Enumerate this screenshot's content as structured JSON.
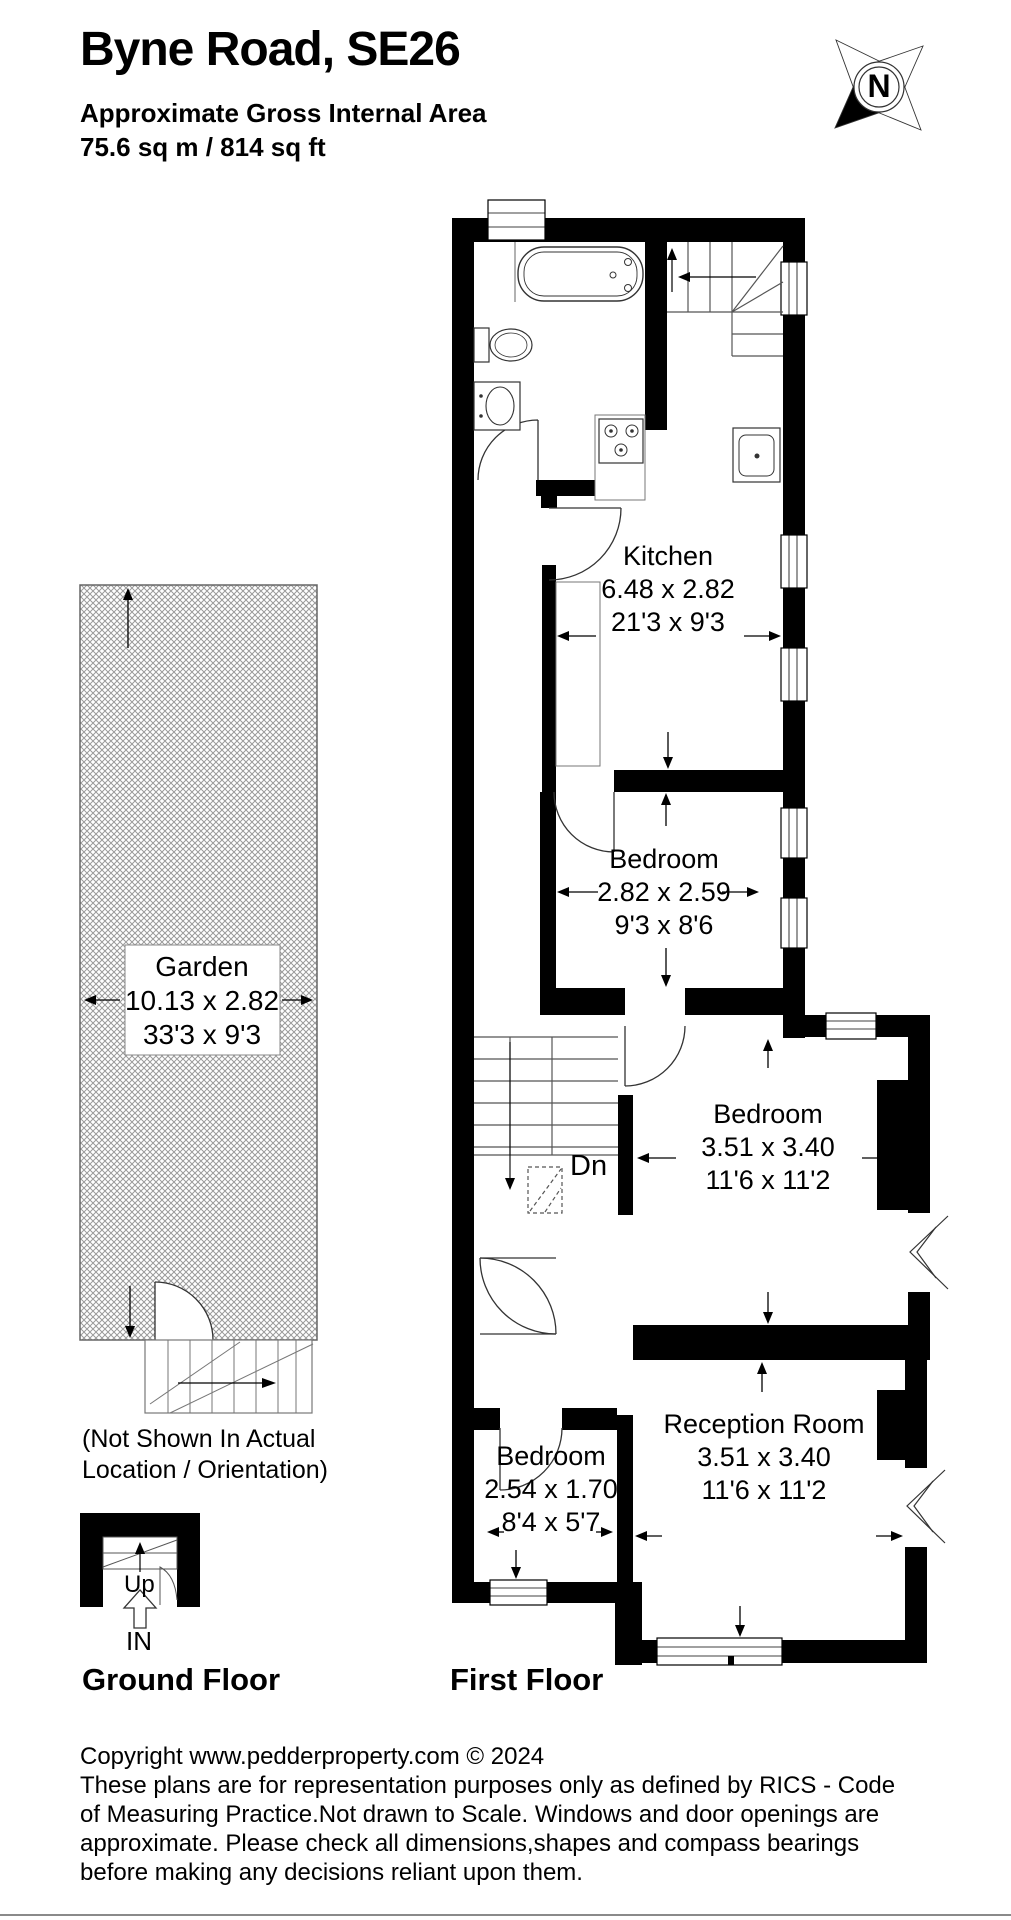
{
  "header": {
    "title": "Byne Road, SE26",
    "area_label": "Approximate Gross Internal Area",
    "area_value": "75.6 sq m / 814 sq ft"
  },
  "compass": {
    "label": "N"
  },
  "rooms": {
    "kitchen": {
      "name": "Kitchen",
      "dim_m": "6.48 x 2.82",
      "dim_ft": "21'3 x 9'3"
    },
    "bedroom1": {
      "name": "Bedroom",
      "dim_m": "2.82 x 2.59",
      "dim_ft": "9'3 x 8'6"
    },
    "bedroom2": {
      "name": "Bedroom",
      "dim_m": "3.51 x 3.40",
      "dim_ft": "11'6 x 11'2"
    },
    "reception": {
      "name": "Reception Room",
      "dim_m": "3.51 x 3.40",
      "dim_ft": "11'6 x 11'2"
    },
    "bedroom3": {
      "name": "Bedroom",
      "dim_m": "2.54 x 1.70",
      "dim_ft": "8'4 x 5'7"
    },
    "garden": {
      "name": "Garden",
      "dim_m": "10.13 x 2.82",
      "dim_ft": "33'3 x 9'3"
    }
  },
  "annotations": {
    "stairs_down": "Dn",
    "stairs_up": "Up",
    "entrance": "IN",
    "garden_note_line1": "(Not Shown In Actual",
    "garden_note_line2": "Location / Orientation)"
  },
  "floor_labels": {
    "ground": "Ground Floor",
    "first": "First Floor"
  },
  "footer": {
    "line1": "Copyright www.pedderproperty.com © 2024",
    "line2": "These plans are for representation purposes only as defined by RICS - Code",
    "line3": "of Measuring Practice.Not drawn to Scale. Windows and door openings are",
    "line4": "approximate. Please check all dimensions,shapes and compass bearings",
    "line5": "before making any decisions reliant upon them."
  }
}
